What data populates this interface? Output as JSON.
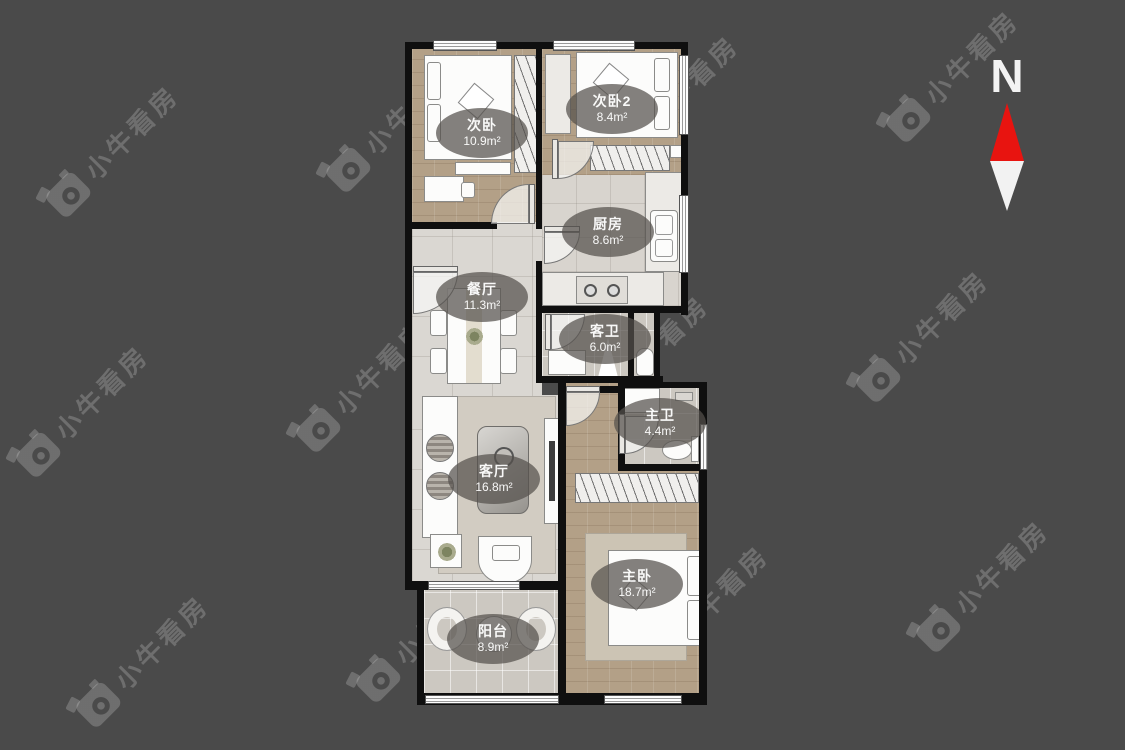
{
  "page": {
    "background": "#4a4a4a"
  },
  "watermark": {
    "text": "小牛看房"
  },
  "compass": {
    "label": "N",
    "north_color": "#e81410",
    "south_color": "#f2f2f2"
  },
  "floor_plan": {
    "rooms": {
      "bedroom2": {
        "name": "次卧",
        "area": "10.9m²"
      },
      "bedroom3": {
        "name": "次卧2",
        "area": "8.4m²"
      },
      "kitchen": {
        "name": "厨房",
        "area": "8.6m²"
      },
      "dining": {
        "name": "餐厅",
        "area": "11.3m²"
      },
      "guest_bath": {
        "name": "客卫",
        "area": "6.0m²"
      },
      "master_bath": {
        "name": "主卫",
        "area": "4.4m²"
      },
      "living": {
        "name": "客厅",
        "area": "16.8m²"
      },
      "master_bedroom": {
        "name": "主卧",
        "area": "18.7m²"
      },
      "balcony": {
        "name": "阳台",
        "area": "8.9m²"
      }
    }
  }
}
